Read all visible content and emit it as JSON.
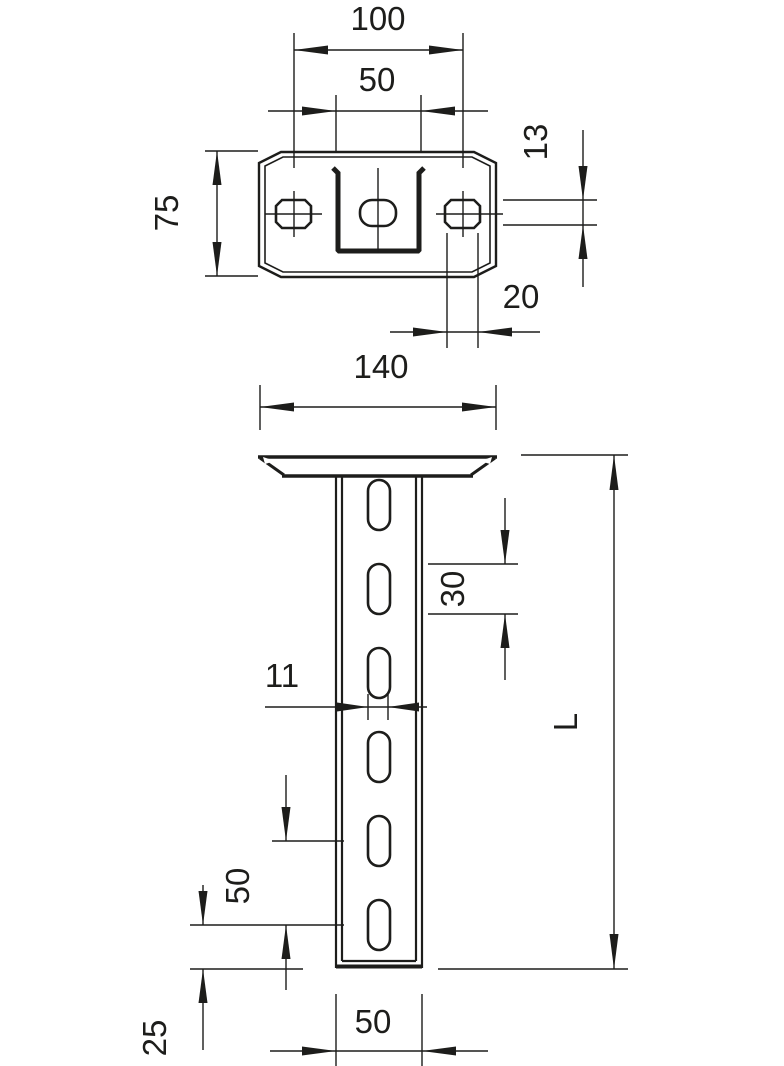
{
  "drawing": {
    "kind": "technical dimension drawing, ceiling bracket with slotted channel",
    "colors": {
      "line": "#1d1d1b",
      "background": "#ffffff"
    },
    "top_view": {
      "dimensions": {
        "hole_spacing": "100",
        "channel_width": "50",
        "plate_depth": "75",
        "side_slot_height": "13",
        "side_slot_width": "20",
        "plate_width": "140"
      }
    },
    "front_view": {
      "dimensions": {
        "slot_length": "30",
        "slot_width": "11",
        "slot_pitch": "50",
        "bottom_offset": "25",
        "profile_width": "50",
        "total_length": "L"
      }
    }
  }
}
